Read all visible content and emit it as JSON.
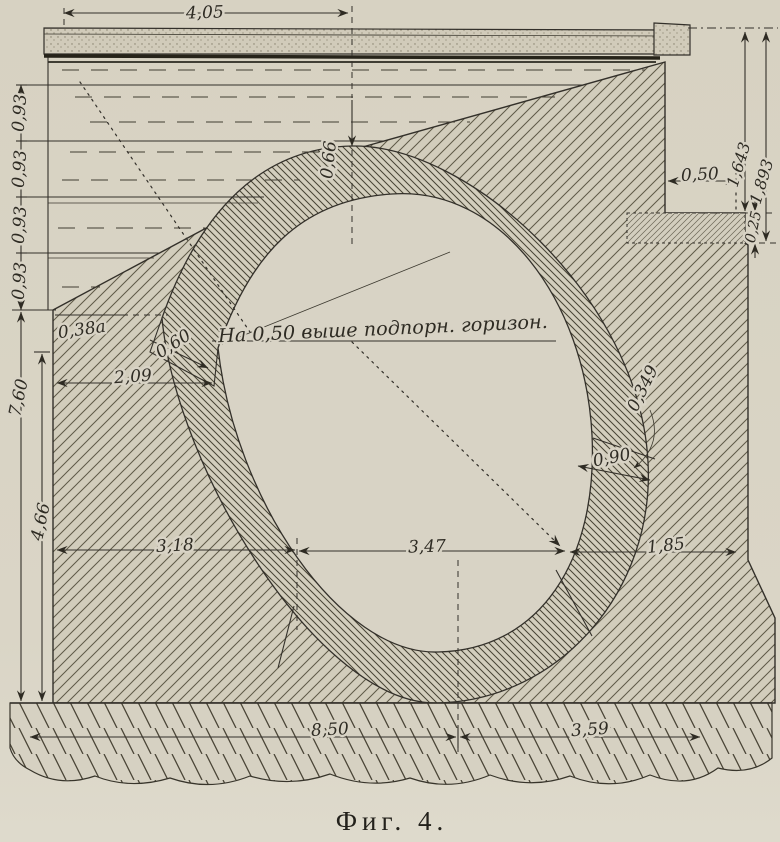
{
  "figure": {
    "caption": "Фиг. 4.",
    "note": "На 0,50 выше подпорн. горизон.",
    "dims": {
      "top_span": "4,05",
      "left_segments": [
        "0,93",
        "0,93",
        "0,93",
        "0,93"
      ],
      "left_total": "7,60",
      "left_lower": "4,66",
      "crown_thickness": "0,66",
      "face_offset": "0,38a",
      "springer_joint": "0,60",
      "springer_offset": "2,09",
      "joint_arc": "0,349",
      "right_joint": "0,90",
      "span_left": "3,18",
      "span_mid": "3,47",
      "span_right": "1,85",
      "base_main": "8,50",
      "base_right": "3,59",
      "parapet_inner": "1,643",
      "parapet_outer": "1,893",
      "ledge_width": "0,50",
      "ledge_height": "0,25"
    }
  }
}
